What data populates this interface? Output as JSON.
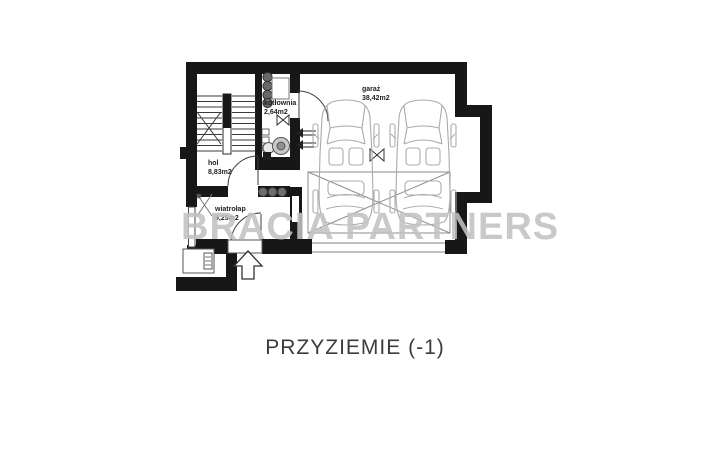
{
  "title": "PRZYZIEMIE (-1)",
  "watermark": "BRACIA PARTNERS",
  "rooms": [
    {
      "id": "kotlownia",
      "label": "kotłownia",
      "area": "2,64m2"
    },
    {
      "id": "garaz",
      "label": "garaż",
      "area": "38,42m2"
    },
    {
      "id": "hol",
      "label": "hol",
      "area": "8,83m2"
    },
    {
      "id": "wiatrolap",
      "label": "wiatrołap",
      "area": "5,25m2"
    }
  ],
  "icons": {
    "entrance_arrow": "arrow-up-outline",
    "boiler": "stacked-circles",
    "pump": "concentric-circles",
    "valve": "bowtie",
    "flue": "double-arrow-left"
  },
  "colors": {
    "wall": "#171717",
    "thin_line": "#3f3f3f",
    "furniture_line": "#ababab",
    "label_text": "#222222",
    "title_text": "#3c3c3c",
    "watermark_text": "#c1c1c1"
  }
}
